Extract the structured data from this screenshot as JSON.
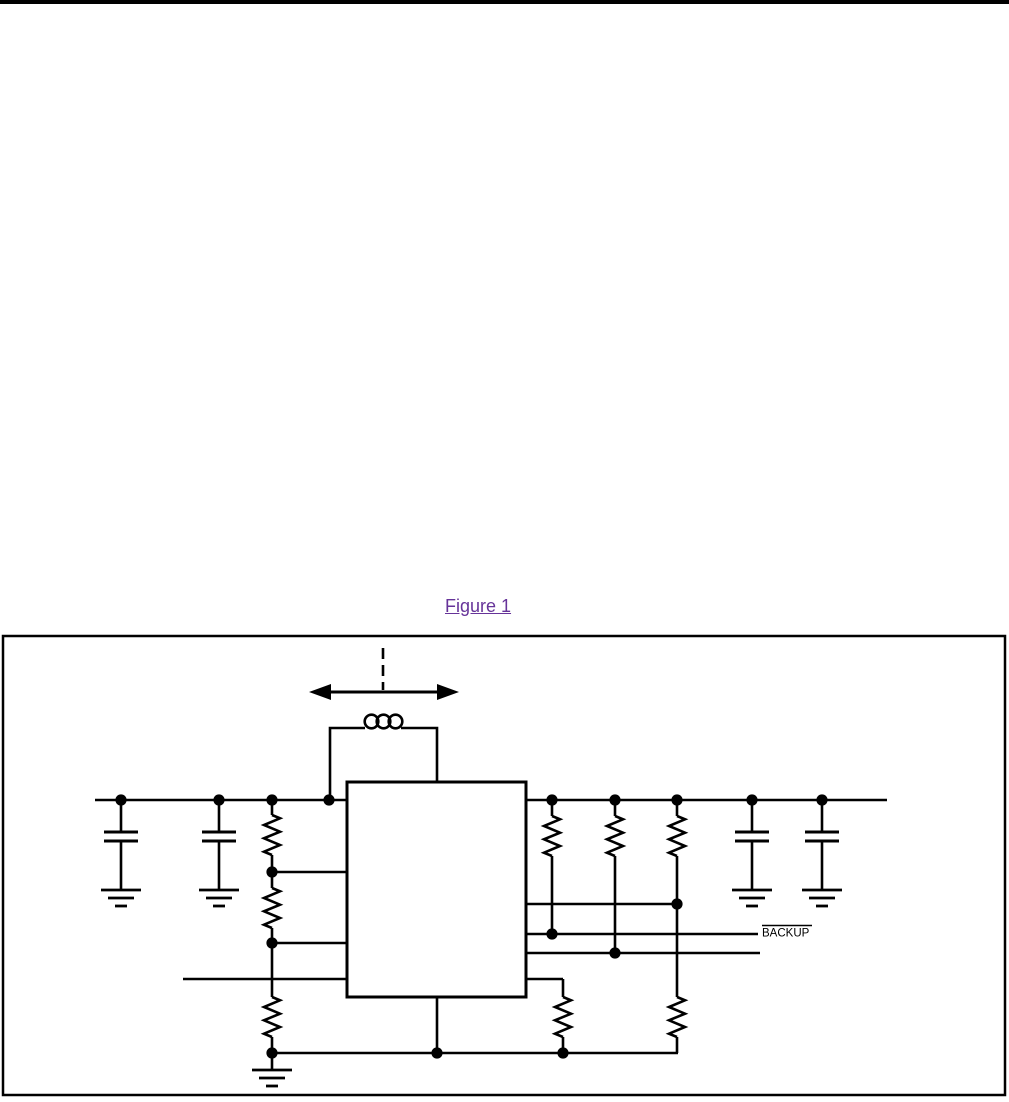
{
  "page": {
    "background_color": "#ffffff",
    "top_bar_color": "#000000"
  },
  "figure_link": {
    "label": "Figure 1",
    "color": "#663399"
  },
  "schematic": {
    "backup_label": "BACKUP",
    "line_color": "#000000",
    "icons": [
      "double-headed-arrow-icon",
      "dashed-center-line",
      "inductor-icon",
      "ic-block",
      "capacitor-icon",
      "resistor-icon",
      "ground-icon",
      "junction-dot",
      "power-rail",
      "backup-signal-line"
    ]
  }
}
